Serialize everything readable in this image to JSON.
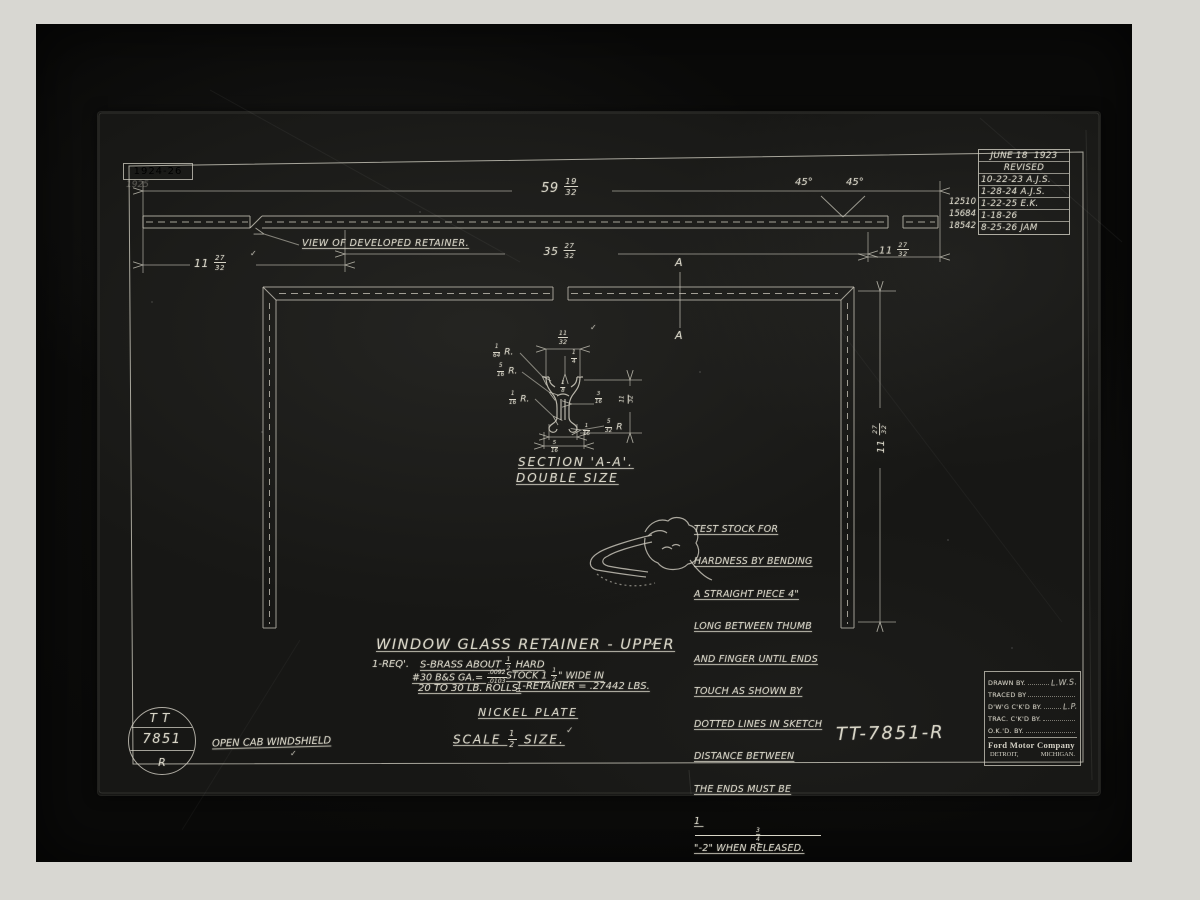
{
  "sheet": {
    "year_box": {
      "text": "1924-26",
      "faint": "1925"
    },
    "revision_table": {
      "date": "JUNE 18  1923",
      "revised": "REVISED",
      "entries": [
        {
          "no": "",
          "text": "10-22-23 A.J.S."
        },
        {
          "no": "",
          "text": "1-28-24 A.J.S."
        },
        {
          "no": "12510",
          "text": "1-22-25 E.K."
        },
        {
          "no": "15684",
          "text": "1-18-26"
        },
        {
          "no": "18542",
          "text": "8-25-26 JAM"
        }
      ]
    },
    "developed_view": {
      "label": "VIEW OF DEVELOPED RETAINER.",
      "overall_length": "59 19/32",
      "left_length": "11 27/32",
      "center_length": "35 27/32",
      "right_length": "11 27/32",
      "angle_left": "45°",
      "angle_right": "45°"
    },
    "installed_view": {
      "section_letter_top": "A",
      "section_letter_bottom": "A",
      "height": "11 27/32"
    },
    "section_detail": {
      "title": "SECTION 'A-A'.",
      "subtitle": "DOUBLE SIZE",
      "top_width": "11/32",
      "lip_depth": "1/4",
      "radius_1": "1/64 R.",
      "radius_2": "5/16 R.",
      "radius_3": "1/16 R.",
      "inner_width": "1/8",
      "inner_offset": "3/16",
      "height": "11/32",
      "radius_4": "5/32 R",
      "stem_width": "1/16",
      "bottom_width": "5/16"
    },
    "test_note": {
      "lines": [
        "TEST STOCK FOR",
        "HARDNESS BY BENDING",
        "A STRAIGHT PIECE 4\"",
        "LONG BETWEEN THUMB",
        "AND FINGER UNTIL ENDS",
        "TOUCH AS SHOWN BY",
        "DOTTED LINES IN SKETCH",
        "DISTANCE BETWEEN",
        "THE ENDS MUST BE",
        "1 3/4\"-2\" WHEN RELEASED."
      ]
    },
    "title_area": {
      "title": "WINDOW GLASS RETAINER - UPPER",
      "req": "1-REQ'.",
      "material": "S-BRASS ABOUT 1/2 HARD",
      "gauge": "#30 B&S GA.= .0092/.0103",
      "stock": "STOCK 1 1/2\" WIDE IN",
      "rolls": "20 TO 30 LB. ROLLS.",
      "weight": "1-RETAINER = .27442 LBS.",
      "finish": "NICKEL PLATE",
      "scale": "SCALE 1/2 SIZE."
    },
    "stamp": {
      "line1": "TT",
      "line2": "7851",
      "line3": "R"
    },
    "caption": "OPEN CAB WINDSHIELD",
    "drawing_number": "TT-7851-R",
    "title_block": {
      "rows": [
        {
          "label": "DRAWN BY.",
          "sig": "L.W.S."
        },
        {
          "label": "TRACED BY",
          "sig": ""
        },
        {
          "label": "D'W'G C'K'D BY.",
          "sig": "L.P."
        },
        {
          "label": "TRAC. C'K'D BY.",
          "sig": ""
        },
        {
          "label": "O.K.'D. BY.",
          "sig": ""
        }
      ],
      "company": "Ford Motor Company",
      "city": "DETROIT,",
      "state": "MICHIGAN."
    },
    "check": "✓"
  }
}
